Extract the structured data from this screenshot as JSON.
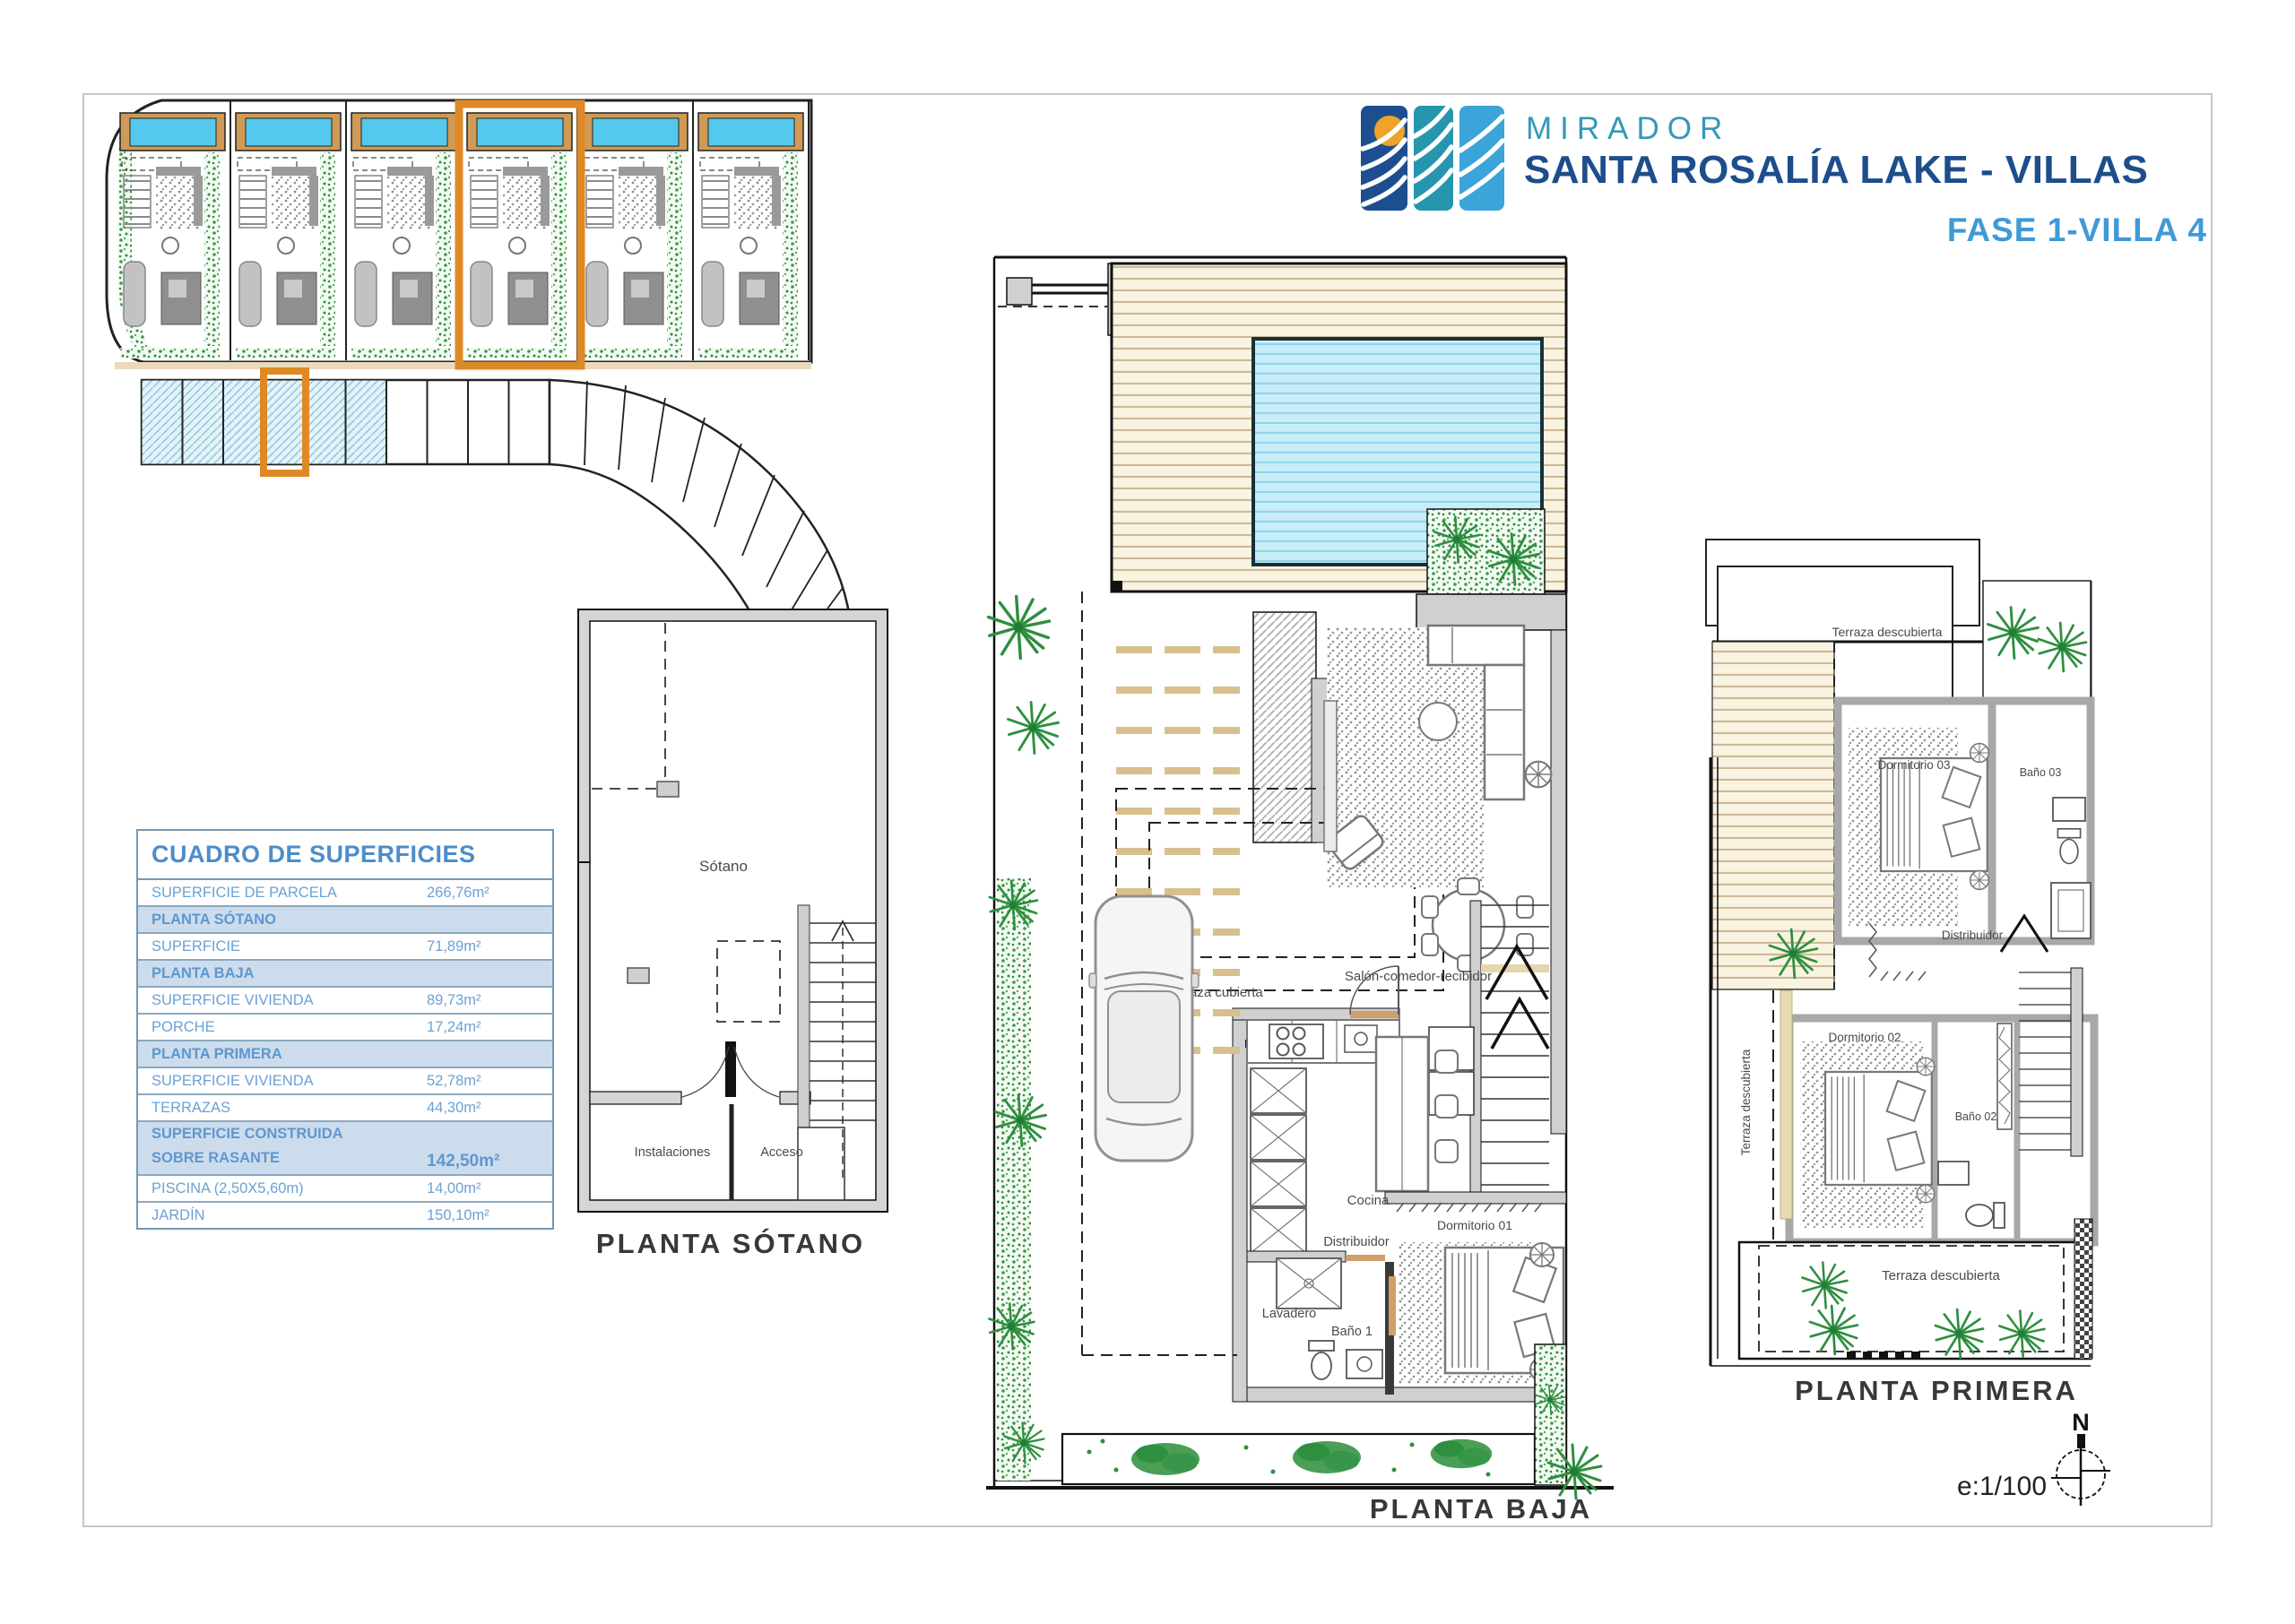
{
  "header": {
    "brand_line1": "MIRADOR",
    "brand_line2": "SANTA ROSALÍA LAKE - VILLAS",
    "phase_label": "FASE 1-VILLA 4"
  },
  "areas_table": {
    "title": "CUADRO DE SUPERFICIES",
    "rows": [
      {
        "type": "data",
        "label": "SUPERFICIE DE PARCELA",
        "value": "266,76m²"
      },
      {
        "type": "section",
        "label": "PLANTA SÓTANO"
      },
      {
        "type": "data",
        "label": "SUPERFICIE",
        "value": "71,89m²"
      },
      {
        "type": "section",
        "label": "PLANTA BAJA"
      },
      {
        "type": "data",
        "label": "SUPERFICIE VIVIENDA",
        "value": "89,73m²"
      },
      {
        "type": "data",
        "label": "PORCHE",
        "value": "17,24m²"
      },
      {
        "type": "section",
        "label": "PLANTA PRIMERA"
      },
      {
        "type": "data",
        "label": "SUPERFICIE VIVIENDA",
        "value": "52,78m²"
      },
      {
        "type": "data",
        "label": "TERRAZAS",
        "value": "44,30m²"
      },
      {
        "type": "total",
        "label_line1": "SUPERFICIE CONSTRUIDA",
        "label_line2": "SOBRE RASANTE",
        "value": "142,50m²"
      },
      {
        "type": "data",
        "label": "PISCINA (2,50X5,60m)",
        "value": "14,00m²"
      },
      {
        "type": "data",
        "label": "JARDÍN",
        "value": "150,10m²"
      }
    ]
  },
  "plans": {
    "sotano": {
      "caption": "PLANTA SÓTANO",
      "rooms": {
        "main": "Sótano",
        "instalaciones": "Instalaciones",
        "acceso": "Acceso"
      }
    },
    "baja": {
      "caption": "PLANTA BAJA",
      "rooms": {
        "terraza_cubierta": "Terraza cubierta",
        "salon": "Salón-comedor-recibidor",
        "cocina": "Cocina",
        "distribuidor": "Distribuidor",
        "lavadero": "Lavadero",
        "bano": "Baño 1",
        "dormitorio": "Dormitorio 01"
      }
    },
    "primera": {
      "caption": "PLANTA PRIMERA",
      "rooms": {
        "terraza_top": "Terraza descubierta",
        "terraza_left": "Terraza descubierta",
        "terraza_bottom": "Terraza descubierta",
        "dormitorio3": "Dormitorio 03",
        "bano3": "Baño 03",
        "distribuidor": "Distribuidor",
        "dormitorio2": "Dormitorio 02",
        "bano2": "Baño 02"
      }
    }
  },
  "compass": {
    "north_label": "N",
    "scale_label": "e:1/100"
  },
  "colors": {
    "accent_orange": "#dd8a26",
    "brand_navy": "#1d4e8b",
    "brand_teal": "#3598ba",
    "brand_lightblue": "#3f9ad6",
    "table_blue": "#6ba1d4",
    "table_header_bg": "#cddcec",
    "pool_cyan": "#55c9ed",
    "deck_tan": "#f9f3e2",
    "vegetation_green": "#2e8f3f",
    "wall_gray": "#d0d0d0"
  }
}
